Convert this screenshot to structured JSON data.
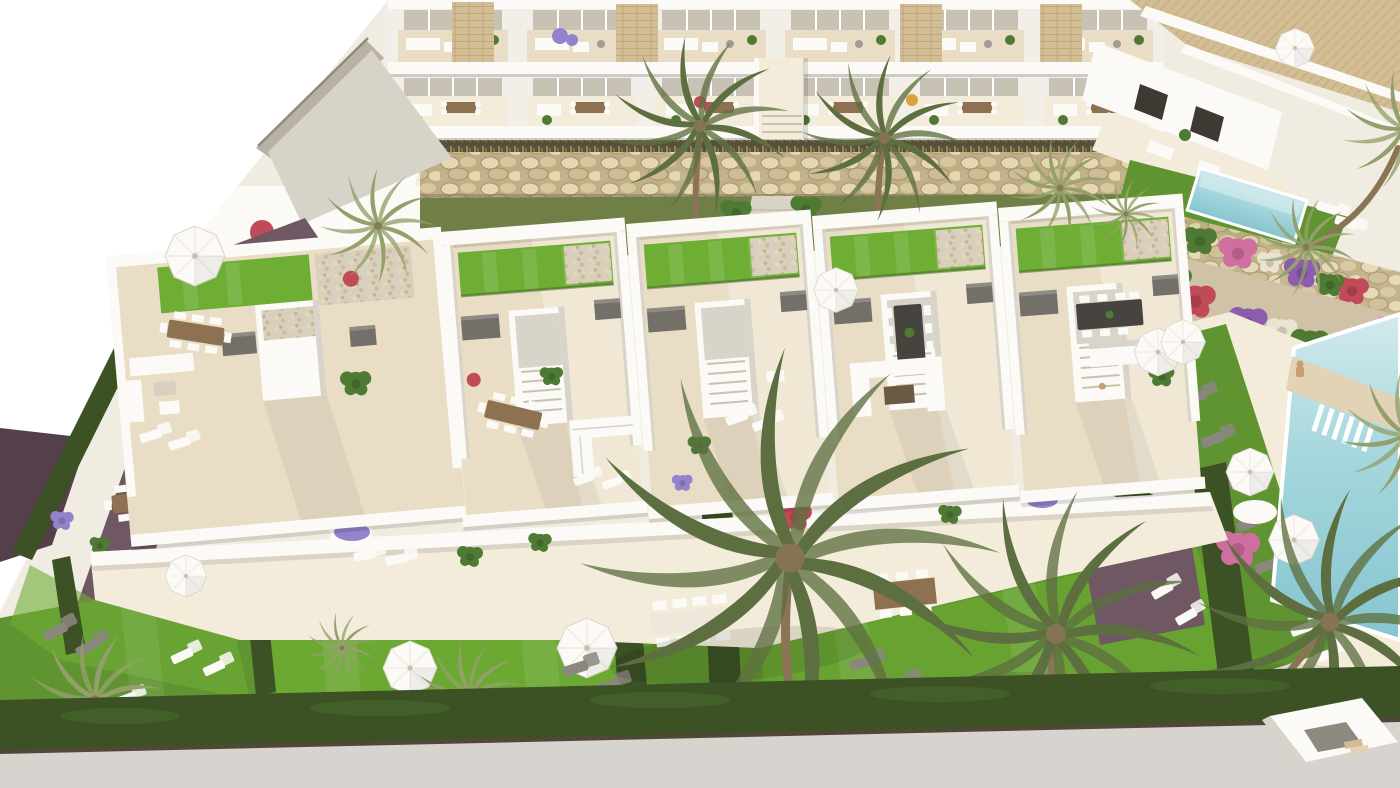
{
  "scene": {
    "type": "3d-architectural-render",
    "view": "aerial-perspective",
    "subject": "residential development with roof-terrace townhouses, apartment block, gardens, palm trees and pools",
    "zones": [
      "two-storey apartment terraces row",
      "detached villas with private pool",
      "gabion rock retaining wall",
      "roof-terrace townhouse units with lawns",
      "ground-floor terraces",
      "communal lawned gardens with hedges",
      "communal swimming pool with deck and loungers",
      "flowering rockery garden",
      "street at bottom edge"
    ],
    "counts": {
      "apartment_units": 6,
      "roof_terrace_units": 5,
      "palm_trees": 15,
      "parasols": 10,
      "sun_loungers": 20,
      "pools": 2,
      "people": 2
    }
  },
  "palette": {
    "white": "#ffffff",
    "wallWhite": "#f2efe9",
    "wallBright": "#fbfaf6",
    "wallShade": "#d8d4ca",
    "floorCream": "#e9ddc6",
    "floorLight": "#f4ecdb",
    "tileWarm": "#e2d3b6",
    "stoneTan": "#d3bd94",
    "rockBg": "#bfae86",
    "rockA": "#e4d7b2",
    "rockB": "#d6c79f",
    "rockC": "#cdbd95",
    "rockD": "#c4b48c",
    "rockDark": "#a3906a",
    "brickLine": "#bfa87c",
    "grassBright": "#6fae35",
    "grassMid": "#5f9430",
    "grassOlive": "#6f7f45",
    "grassDark": "#46622a",
    "hedge": "#3c5124",
    "palmLight": "#93a06b",
    "palmDark": "#5d6f40",
    "trunkBrown": "#8b7355",
    "poolLight": "#d2eaed",
    "poolMid": "#a4d6dd",
    "poolDeep": "#86c5cf",
    "roadGray": "#d7d3ce",
    "roadEdge": "#55463a",
    "pathMauve": "#705764",
    "pathDark": "#53404b",
    "gravel": "#d9cfbf",
    "gravelPath": "#d9d4c6",
    "gardenSoil": "#cfc2a6",
    "boxGray": "#73706a",
    "boxTop": "#8e8b84",
    "furnWhite": "#fbfaf7",
    "furnGray": "#a09d94",
    "loungerGray": "#8a877e",
    "woodBrown": "#8d7150",
    "coffeeBrown": "#6b5a43",
    "tableDark": "#474440",
    "tablePale": "#efe8da",
    "glassTint": "#c8c2b4",
    "doorDark": "#3e3a33",
    "rampPave": "#d7d3c8",
    "rampWall": "#b9b2a4",
    "railGray": "#8d8a80",
    "stepGray": "#c9c2b2",
    "dryBg": "#57503d",
    "dryTuft": "#948a52",
    "dryTuft2": "#7d7344",
    "leafGreen": "#4e7a34",
    "flowerRed": "#c04a57",
    "flowerPurple": "#8e5cae",
    "flowerLavender": "#9383cc",
    "flowerYellow": "#d8a43e",
    "flowerPink": "#cf6f9f",
    "flowerWhite": "#e9e4d2",
    "skin": "#c99c72"
  }
}
